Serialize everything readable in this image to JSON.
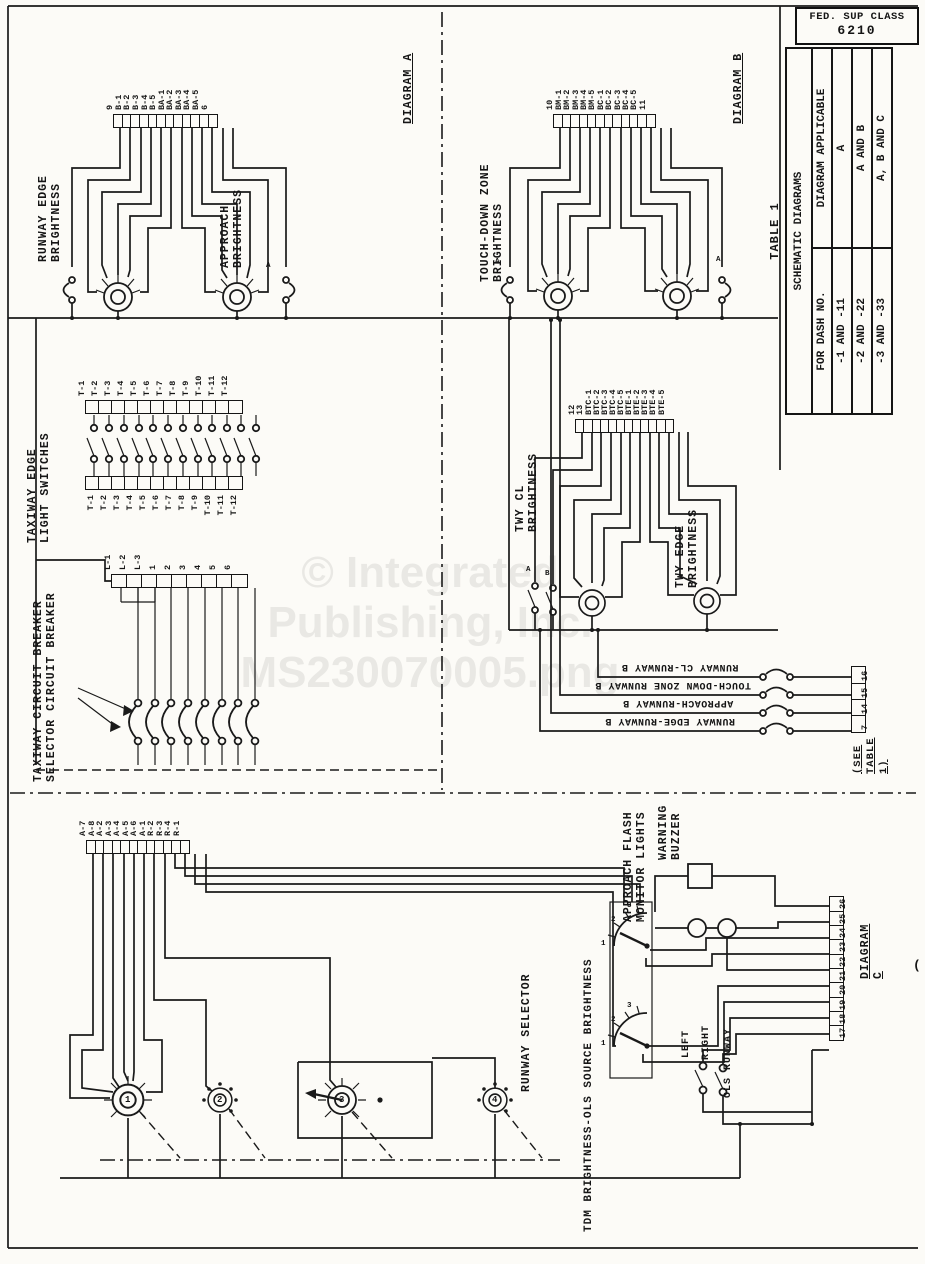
{
  "page": {
    "fed_sup_class": "FED. SUP CLASS",
    "fed_sup_value": "6210",
    "watermark_lines": [
      "© Integrated",
      "Publishing, Inc.",
      "MS230070005.png"
    ],
    "corner_mark": "("
  },
  "table1": {
    "caption": "TABLE 1",
    "title": "SCHEMATIC DIAGRAMS",
    "col_dash": "FOR DASH NO.",
    "col_diagram": "DIAGRAM APPLICABLE",
    "rows": [
      {
        "dash": "-1 AND -11",
        "diagram": "A"
      },
      {
        "dash": "-2 AND -22",
        "diagram": "A AND B"
      },
      {
        "dash": "-3 AND -33",
        "diagram": "A, B AND C"
      }
    ]
  },
  "diagram_a": {
    "label": "DIAGRAM A",
    "runway_edge_label": "RUNWAY EDGE\nBRIGHTNESS",
    "approach_label": "APPROACH\nBRIGHTNESS",
    "terminals": [
      "9",
      "B-1",
      "B-2",
      "B-3",
      "B-4",
      "B-5",
      "BA-1",
      "BA-2",
      "BA-3",
      "BA-4",
      "BA-5",
      "6"
    ],
    "contact_label": "A"
  },
  "diagram_b": {
    "label": "DIAGRAM B",
    "tdz_label": "TOUCH-DOWN ZONE\nBRIGHTNESS",
    "tdz_terminals": [
      "10",
      "BM-1",
      "BM-2",
      "BM-3",
      "BM-4",
      "BM-5",
      "BC-1",
      "BC-2",
      "BC-3",
      "BC-4",
      "BC-5",
      "11"
    ],
    "contact_label_left": "A",
    "contact_label_right": "A",
    "twy_cl_label": "TWY CL\nBRIGHTNESS",
    "twy_edge_label": "TWY EDGE\nBRIGHTNESS",
    "twy_terminals": [
      "12",
      "13",
      "BTC-1",
      "BTC-2",
      "BTC-3",
      "BTC-4",
      "BTC-5",
      "BTE-1",
      "BTE-2",
      "BTE-3",
      "BTE-4",
      "BTE-5"
    ],
    "twy_contact_a": "A",
    "twy_contact_b": "B",
    "relay_labels": [
      "RUNWAY CL-RUNWAY B",
      "TOUCH-DOWN ZONE RUNWAY B",
      "APPROACH-RUNWAY B",
      "RUNWAY EDGE-RUNWAY B"
    ],
    "relay_terminals": [
      "16",
      "15",
      "14",
      "7"
    ],
    "see_table": "(SEE TABLE 1)"
  },
  "taxiway": {
    "switches_label": "TAXIWAY EDGE\nLIGHT SWITCHES",
    "top_terminals": [
      "T-1",
      "T-2",
      "T-3",
      "T-4",
      "T-5",
      "T-6",
      "T-7",
      "T-8",
      "T-9",
      "T-10",
      "T-11",
      "T-12"
    ],
    "bottom_terminals": [
      "T-1",
      "T-2",
      "T-3",
      "T-4",
      "T-5",
      "T-6",
      "T-7",
      "T-8",
      "T-9",
      "T-10",
      "T-11",
      "T-12"
    ],
    "breaker_label": "TAXIWAY CIRCUIT BREAKER\nSELECTOR CIRCUIT BREAKER",
    "breaker_terminals": [
      "L-1",
      "L-2",
      "L-3",
      "1",
      "2",
      "3",
      "4",
      "5",
      "6"
    ]
  },
  "diagram_c": {
    "label": "DIAGRAM C",
    "runway_selector_label": "RUNWAY SELECTOR",
    "selector_terminals": [
      "A-7",
      "A-8",
      "A-2",
      "A-3",
      "A-4",
      "A-5",
      "A-6",
      "A-1",
      "R-2",
      "R-3",
      "R-4",
      "R-1"
    ],
    "switch_numbers": [
      "1",
      "2",
      "3",
      "4"
    ],
    "tdm_label": "TDM BRIGHTNESS-OLS SOURCE BRIGHTNESS",
    "flash_label": "APPROACH FLASH\nMONITOR LIGHTS",
    "buzzer_label": "WARNING\nBUZZER",
    "selector_positions": [
      "1",
      "2",
      "3"
    ],
    "column_terminals": [
      "26",
      "25",
      "24",
      "23",
      "22",
      "21",
      "20",
      "19",
      "18",
      "17"
    ],
    "left_label": "LEFT",
    "right_label": "RIGHT",
    "ols_label": "OLS RUNWAY"
  }
}
